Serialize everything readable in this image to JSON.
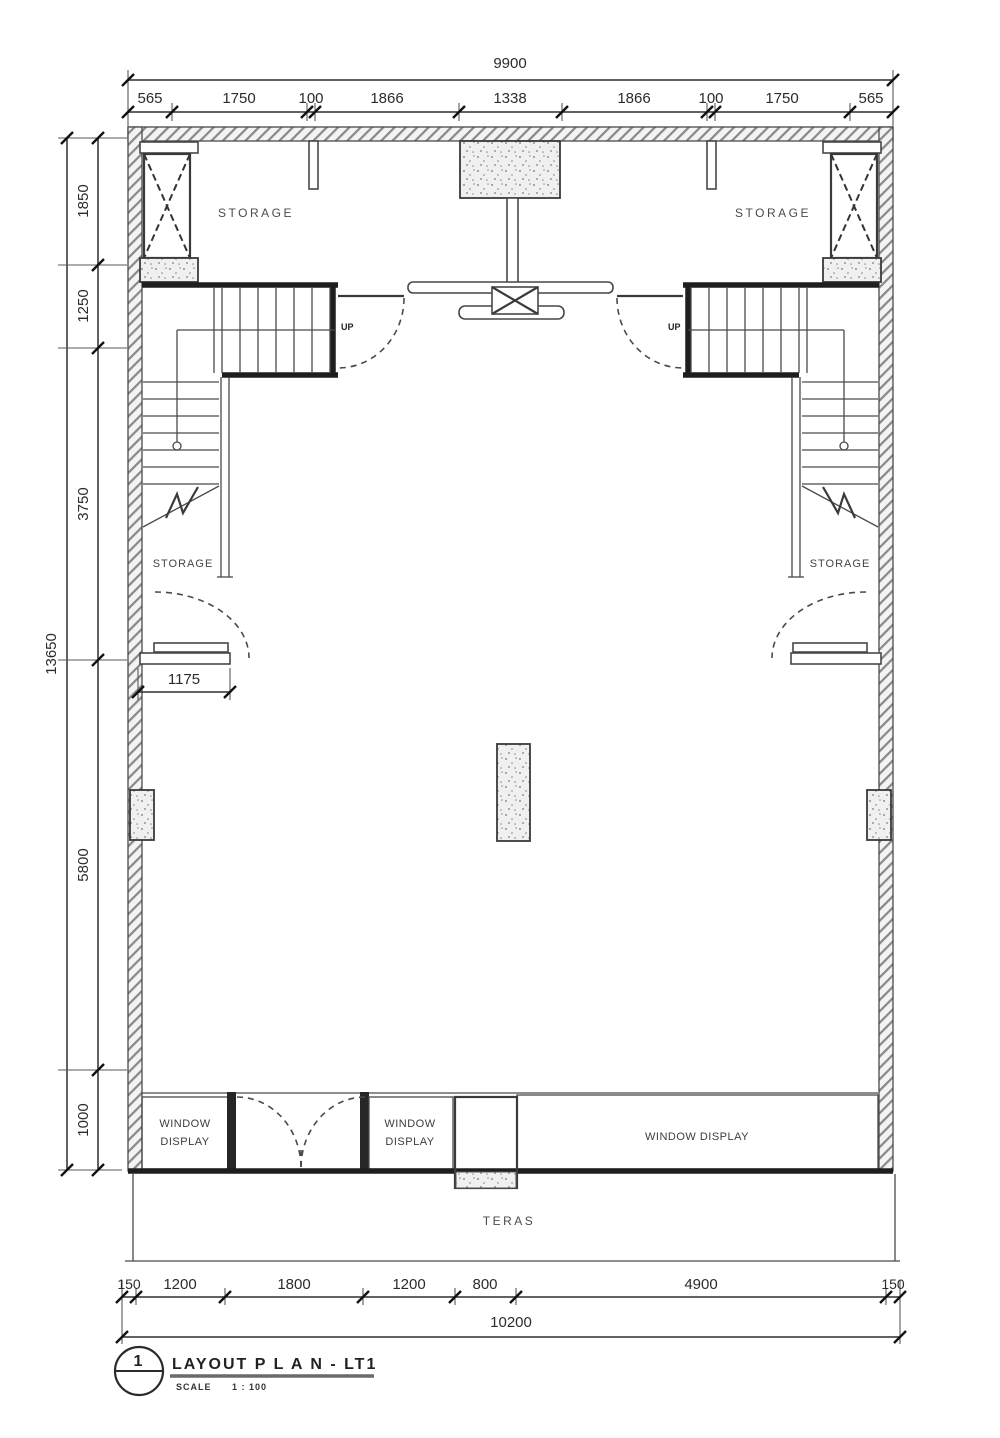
{
  "drawing": {
    "labels": {
      "storage": "STORAGE",
      "up": "UP",
      "window_line1": "WINDOW",
      "window_line2": "DISPLAY",
      "window_display": "WINDOW DISPLAY",
      "teras": "TERAS"
    },
    "dimensions": {
      "top_total": "9900",
      "top_segments": [
        "565",
        "1750",
        "100",
        "1866",
        "1338",
        "1866",
        "100",
        "1750",
        "565"
      ],
      "left_total": "13650",
      "left_segments": [
        "1850",
        "1250",
        "3750",
        "5800",
        "1000"
      ],
      "interior_left_width": "1175",
      "bottom_segments": [
        "150",
        "1200",
        "1800",
        "1200",
        "800",
        "4900",
        "150"
      ],
      "bottom_total": "10200"
    },
    "titleblock": {
      "number": "1",
      "title": "LAYOUT   P L A N  -  LT1",
      "scale_label": "SCALE",
      "scale_value": "1 : 100"
    }
  }
}
